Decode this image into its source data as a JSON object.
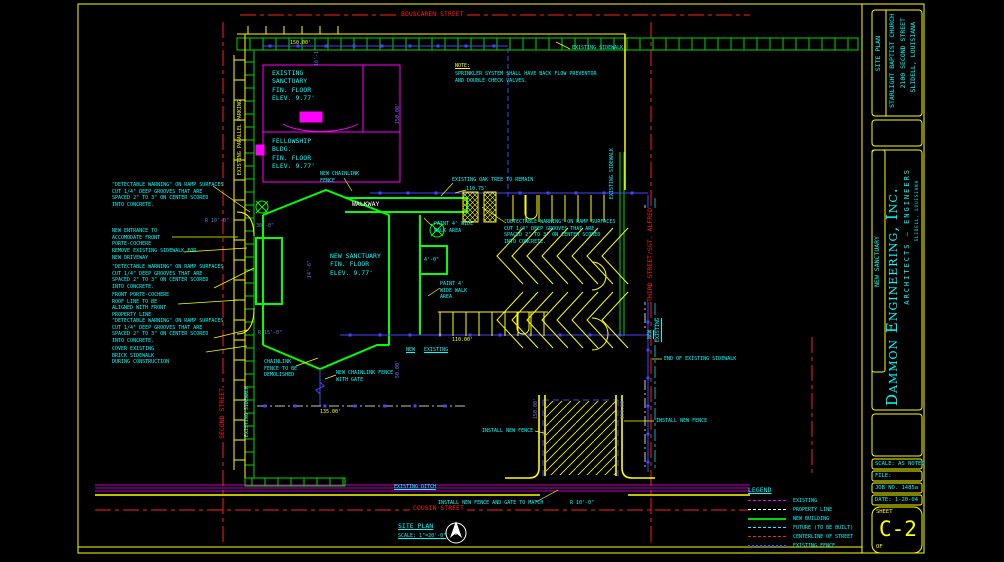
{
  "streets": {
    "bouscaren": "BOUSCAREN STREET",
    "second": "SECOND STREET",
    "cousin": "COUSIN STREET",
    "third": "THIRD STREET/SGT. ALFRED"
  },
  "note": {
    "title": "NOTE:",
    "body": "SPRINKLER SYSTEM SHALL HAVE BACK FLOW PREVENTOR\nAND DOUBLE CHECK VALVES."
  },
  "buildings": {
    "existing_sanctuary": "EXISTING\nSANCTUARY\nFIN. FLOOR\nELEV. 9.77'",
    "fellowship": "FELLOWSHIP\nBLDG.\nFIN. FLOOR\nELEV. 9.77'",
    "new_sanctuary": "NEW SANCTUARY\nFIN. FLOOR\nELEV. 9.77'",
    "walkway": "WALKWAY"
  },
  "callouts": {
    "detectable_warning": "\"DETECTABLE WARNING\" ON RAMP SURFACES\nCUT 1/4\" DEEP GROOVES THAT ARE\nSPACED 2\" TO 3\" ON CENTER SCORED\nINTO CONCRETE.",
    "new_entrance": "NEW ENTRANCE TO\nACCOMODATE FRONT\nPORTE-COCHERE",
    "remove_sidewalk": "REMOVE EXISTING SIDEWALK FOR\nNEW DRIVEWAY",
    "front_porte": "FRONT PORTE-COCHERE\nROOF LINE TO BE\nALIGNED WITH FRONT\nPROPERTY LINE",
    "cover_brick": "COVER EXISTING\nBRICK SIDEWALK\nDURING CONSTRUCTION",
    "chainlink_demolish": "CHAINLINK\nFENCE TO BE\nDEMOLISHED",
    "new_chainlink_fence": "NEW CHAINLINK\nFENCE",
    "new_chainlink_gate": "NEW CHAINLINK FENCE\nWITH GATE",
    "existing_ditch": "EXISTING DITCH",
    "end_sidewalk": "END OF EXISTING SIDEWALK",
    "install_fence": "INSTALL NEW FENCE",
    "install_fence_gate": "INSTALL NEW FENCE AND GATE TO MATCH",
    "oak_tree": "EXISTING OAK TREE TO REMAIN",
    "paint_walk_1": "PAINT 4' WIDE\nWALK AREA",
    "paint_walk_2": "PAINT 4'\nWIDE WALK\nAREA",
    "existing_sidewalk": "EXISTING SIDEWALK",
    "existing_parallel_parking": "EXISTING PARALLEL PARKING",
    "new": "NEW",
    "existing": "EXISTING"
  },
  "dims": {
    "d150": "150.00'",
    "d135": "135.00'",
    "d110": "110.00'",
    "d110_75": "110.75'",
    "d16_1": "16'-1\"",
    "d14_6": "14'-6\"",
    "d50": "50.00'",
    "d30": "30'-0\"",
    "r10": "R 10'-0\"",
    "r15": "R 15'-0\"",
    "d4_0": "4'-0\""
  },
  "siteplan": {
    "title": "SITE PLAN",
    "scale": "SCALE: 1\"=20'-0\"",
    "north": "N"
  },
  "legend": {
    "title": "LEGEND",
    "items": [
      {
        "label": "EXISTING",
        "color": "#ff00ff"
      },
      {
        "label": "PROPERTY LINE",
        "color": "#ffffff"
      },
      {
        "label": "NEW BUILDING",
        "color": "#00d900"
      },
      {
        "label": "FUTURE (TO BE BUILT)",
        "color": "#00ffff"
      },
      {
        "label": "CENTERLINE OF STREET",
        "color": "#ff2020"
      },
      {
        "label": "EXISTING FENCE",
        "color": "#4444ff"
      }
    ]
  },
  "titleblock": {
    "sheet_title": "SITE PLAN",
    "project": [
      "STARLIGHT BAPTIST CHURCH",
      "2100 SECOND STREET",
      "SLIDELL, LOUISIANA"
    ],
    "project_name": "NEW SANCTUARY",
    "firm": "Dammon Engineering, Inc.",
    "firm_sub": "ARCHITECTS — ENGINEERS",
    "firm_addr": "SLIDELL, LOUISIANA",
    "scale": "SCALE: AS NOTED",
    "file": "FILE:",
    "job": "JOB NO. 1485a",
    "date": "DATE: 1-20-04",
    "sheet_word": "SHEET",
    "sheet_num": "C-2",
    "of_word": "OF"
  },
  "colors": {
    "yellow": "#ffff00",
    "cyan": "#00ffff",
    "green": "#00d900",
    "magenta": "#ff00ff",
    "red": "#ff2020",
    "blue": "#4444ff",
    "white": "#ffffff"
  }
}
